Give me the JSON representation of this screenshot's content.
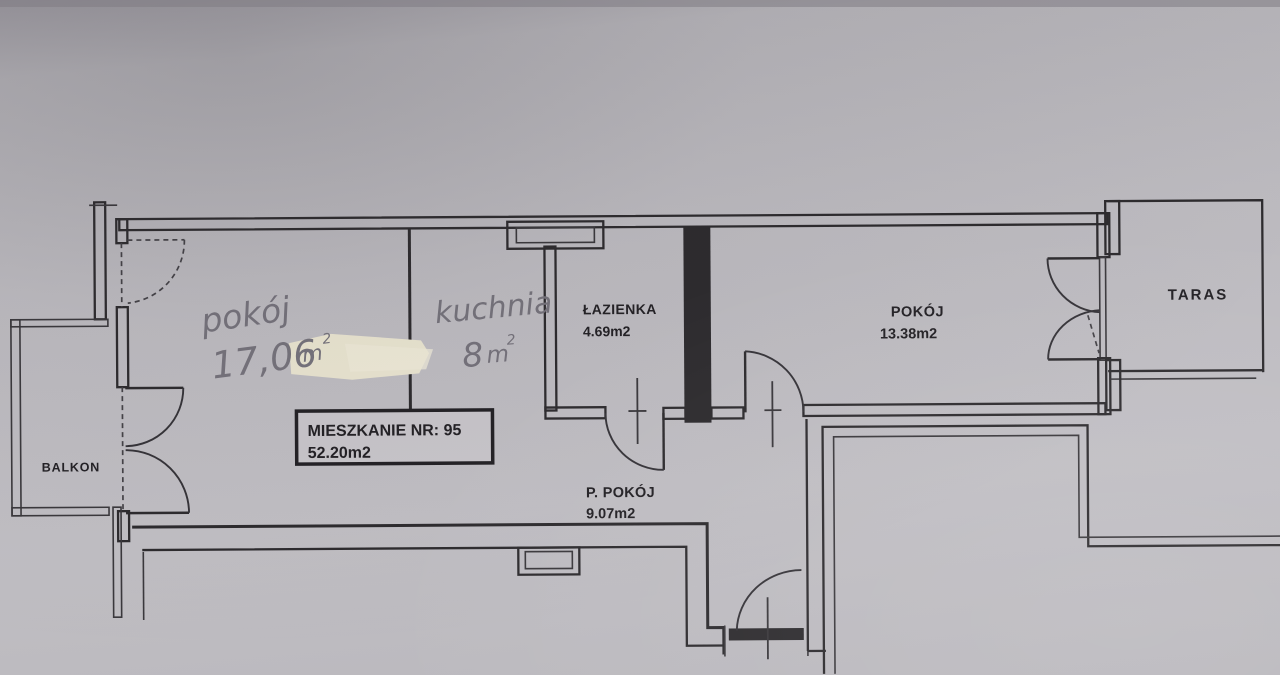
{
  "drawing": {
    "type": "apartment floor plan",
    "paper_color": "#bcbabf",
    "line_color": "#2d2b2e",
    "pencil_color": "#75727b",
    "tippex_color": "#e9e4d0"
  },
  "title_box": {
    "line1": "MIESZKANIE NR: 95",
    "line2": "52.20m2"
  },
  "rooms": {
    "balkon": {
      "label": "BALKON"
    },
    "pokoj_left": {
      "label": "pokój",
      "area_value": "17,06",
      "area_unit": "m",
      "area_sup": "2",
      "style": "handwritten-pencil"
    },
    "kuchnia": {
      "label": "kuchnia",
      "area_value": "8",
      "area_unit": "m",
      "area_sup": "2",
      "style": "handwritten-pencil"
    },
    "lazienka": {
      "label": "ŁAZIENKA",
      "area": "4.69m2"
    },
    "p_pokoj": {
      "label": "P. POKÓJ",
      "area": "9.07m2"
    },
    "pokoj_right": {
      "label": "POKÓJ",
      "area": "13.38m2"
    },
    "taras": {
      "label": "TARAS"
    }
  }
}
